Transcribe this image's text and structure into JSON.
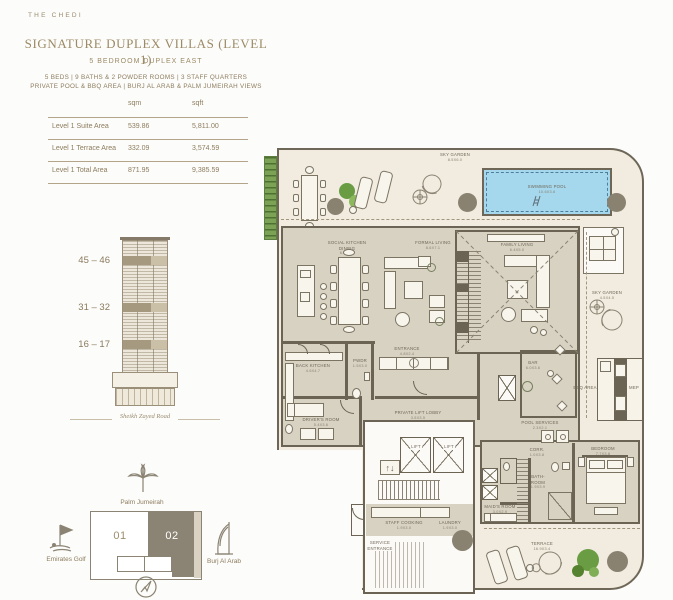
{
  "brand": "THE CHEDI",
  "header": {
    "title": "SIGNATURE DUPLEX VILLAS (LEVEL 1)",
    "subtitle": "5 BEDROOM DUPLEX EAST",
    "spec_line1": "5 BEDS  |  9 BATHS & 2 POWDER ROOMS  |  3 STAFF QUARTERS",
    "spec_line2": "PRIVATE POOL & BBQ AREA |  BURJ AL ARAB & PALM JUMEIRAH VIEWS"
  },
  "area_table": {
    "col_sqm": "sqm",
    "col_sqft": "sqft",
    "rows": [
      {
        "label": "Level 1 Suite Area",
        "sqm": "539.86",
        "sqft": "5,811.00"
      },
      {
        "label": "Level 1 Terrace Area",
        "sqm": "332.09",
        "sqft": "3,574.59"
      },
      {
        "label": "Level 1 Total Area",
        "sqm": "871.95",
        "sqft": "9,385.59"
      }
    ]
  },
  "elevation": {
    "floor_ranges": [
      "45 – 46",
      "31 – 32",
      "16 – 17"
    ],
    "road_label": "Sheikh Zayed Road"
  },
  "site_map": {
    "north_label": "Palm Jumeirah",
    "west_label": "Emirates Golf",
    "east_label": "Burj Al Arab",
    "unit_01": "01",
    "unit_02": "02",
    "highlighted_unit": "02"
  },
  "plan": {
    "lift_arrows": "↑↓",
    "rooms": {
      "sky_garden_top": {
        "label": "SKY GARDEN",
        "dim": "8.5X6.0"
      },
      "swimming_pool": {
        "label": "SWIMMING POOL",
        "dim": "10.6X3.6"
      },
      "social_kitchen": {
        "label": "SOCIAL KITCHEN",
        "label2": "DINING",
        "dim": "6.6X7.7"
      },
      "formal_living": {
        "label": "FORMAL LIVING",
        "dim": "8.6X7.1"
      },
      "family_living": {
        "label": "FAMILY LIVING",
        "dim": "6.4X5.0"
      },
      "sky_garden_right": {
        "label": "SKY GARDEN",
        "dim": "4.5X4.5"
      },
      "entrance": {
        "label": "ENTRANCE",
        "dim": "4.8X2.4"
      },
      "back_kitchen": {
        "label": "BACK KITCHEN",
        "dim": "4.6X4.7"
      },
      "pwdr": {
        "label": "PWDR",
        "dim": "1.5X3.0"
      },
      "bar": {
        "label": "BAR",
        "dim": "6.0X3.6"
      },
      "bbq_area": {
        "label": "BBQ AREA"
      },
      "mep": {
        "label": "MEP"
      },
      "drivers_room": {
        "label": "DRIVER'S ROOM",
        "dim": "5.4X3.6"
      },
      "private_lift_lobby": {
        "label": "PRIVATE LIFT LOBBY",
        "dim": "3.5X3.5"
      },
      "lift": {
        "label": "LIFT"
      },
      "service_entrance": {
        "label": "SERVICE",
        "label2": "ENTRANCE"
      },
      "staff_cooking": {
        "label": "STAFF COOKING",
        "dim": "1.9X3.0"
      },
      "laundry": {
        "label": "LAUNDRY",
        "dim": "1.9X3.0"
      },
      "pool_services": {
        "label": "POOL SERVICES",
        "dim": "2.3X2.1"
      },
      "corr": {
        "label": "CORR.",
        "dim": "1.0X3.8"
      },
      "bathroom": {
        "label": "BATH-",
        "label2": "ROOM",
        "dim": "1.9X3.9"
      },
      "maids_room": {
        "label": "MAID'S ROOM",
        "dim": "3.0X2.9"
      },
      "bedroom": {
        "label": "BEDROOM",
        "dim": "7.7X3.8"
      },
      "terrace": {
        "label": "TERRACE",
        "dim": "16.9X3.4"
      }
    }
  },
  "colors": {
    "accent_gold": "#9c8a66",
    "wall": "#6b6455",
    "indoor": "#d8d2c3",
    "terrace": "#f1ecdf",
    "pool": "#a5d8ec",
    "tree_green": "#6a9c44",
    "planter_dark": "#8a8270"
  }
}
